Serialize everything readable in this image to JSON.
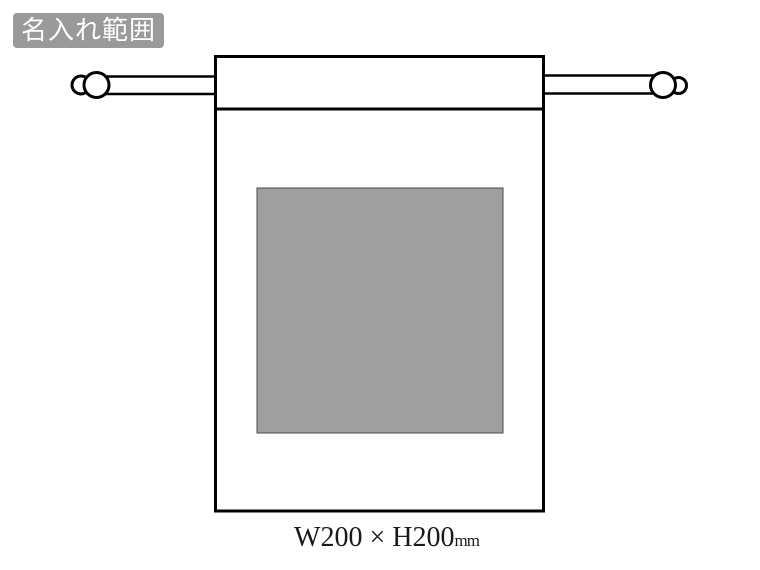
{
  "badge": {
    "label": "名入れ範囲"
  },
  "caption": {
    "size": "W200 × H200",
    "unit": "mm"
  },
  "print_area": {
    "width_mm": "200",
    "height_mm": "200",
    "fill": "#9f9f9f",
    "border": "#4a4a4a"
  },
  "colors": {
    "badge_bg": "#9a9a9a",
    "badge_text": "#ffffff",
    "outline": "#000000",
    "background": "#ffffff"
  }
}
